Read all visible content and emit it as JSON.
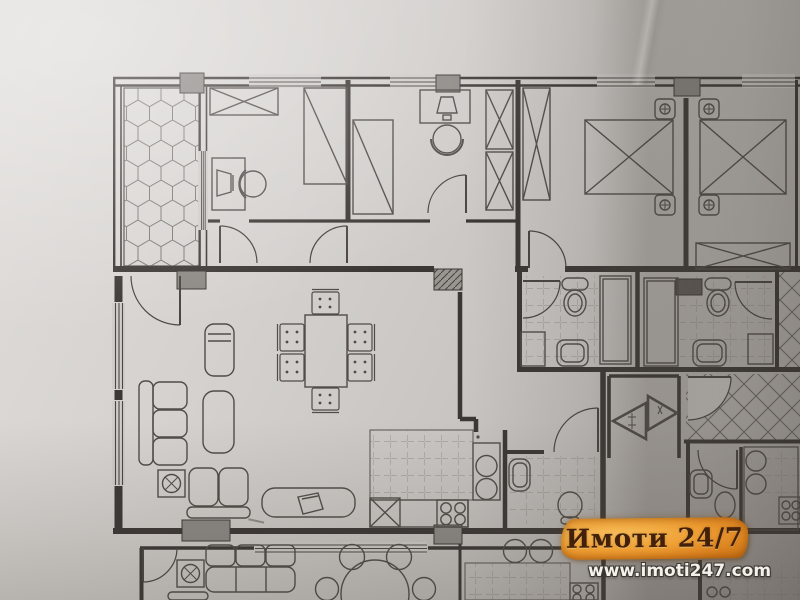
{
  "watermark": {
    "brand": "Имоти 24/7",
    "url": "www.imoti247.com"
  },
  "colors": {
    "paper": "#cfccc9",
    "ink": "#413d3a",
    "column": "#8c8884",
    "column_dark": "#5f5b57",
    "watermark_orange": "#ee9e33",
    "watermark_text": "#43200a",
    "url_text": "#f4f1ed"
  },
  "symbols": [
    "hex-tile-terrace",
    "single-bed",
    "double-bed",
    "wardrobe",
    "desk",
    "desk-chair",
    "sofa-three-seat",
    "sofa-two-seat",
    "armchair",
    "coffee-table",
    "tv-cabinet",
    "potted-plant",
    "dining-table",
    "dining-chair",
    "round-table",
    "kitchen-counter",
    "kitchen-sink",
    "cooktop-stove",
    "toilet",
    "wash-basin",
    "shower-cabin",
    "washing-machine",
    "door-swing",
    "window",
    "structural-column",
    "entrance-arrow",
    "stair-hatch"
  ]
}
